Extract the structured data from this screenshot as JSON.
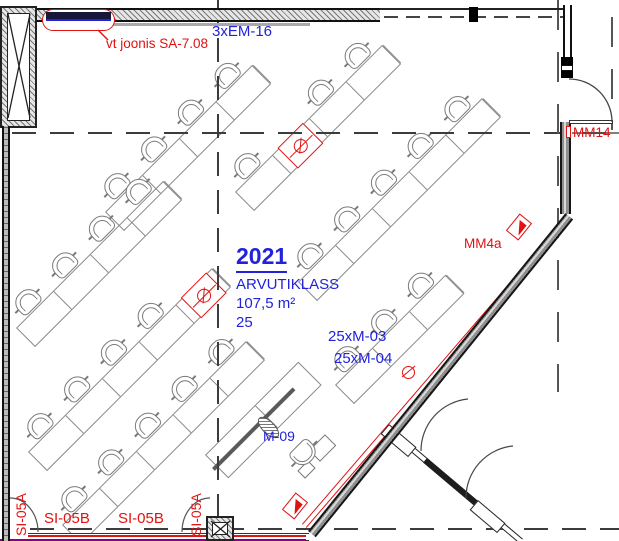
{
  "room": {
    "number": "2021",
    "name": "ARVUTIKLASS",
    "area": "107,5 m²",
    "capacity": "25"
  },
  "annotations": {
    "top_supply": "3xEM-16",
    "revision_note": "vt joonis SA-7.08",
    "cable_run_1": "25xM-03",
    "cable_run_2": "25xM-04",
    "device": "M-09",
    "outlet_wall_right": "MM4a",
    "outlet_door_right": "MM14",
    "switch_left_vertical": "SI-05A",
    "switch_bottom_1": "SI-05B",
    "switch_bottom_2": "SI-05B",
    "switch_right_vertical": "SI-05A"
  },
  "colors": {
    "annotation_blue": "#2222DB",
    "annotation_red": "#E01212",
    "magenta_line": "#8B008B",
    "wall": "#1c1c1c",
    "furniture_gray": "#8a8a8a"
  },
  "furniture": {
    "cell_length": 52,
    "row_depth": 27,
    "rows": [
      {
        "x": 105,
        "y": 212,
        "cells": 4
      },
      {
        "x": 16,
        "y": 328,
        "cells": 4
      },
      {
        "x": 28,
        "y": 452,
        "cells": 5,
        "socket": 4
      },
      {
        "x": 62,
        "y": 525,
        "cells": 5
      },
      {
        "x": 235,
        "y": 192,
        "cells": 4,
        "socket": 1
      },
      {
        "x": 298,
        "y": 282,
        "cells": 5
      },
      {
        "x": 335,
        "y": 385,
        "cells": 3
      }
    ]
  }
}
